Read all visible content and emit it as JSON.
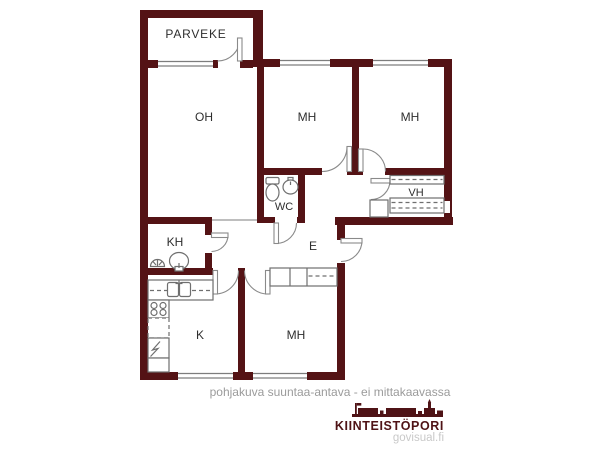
{
  "floorplan": {
    "type": "apartment-floor-plan",
    "rooms": [
      {
        "id": "parveke",
        "label": "PARVEKE"
      },
      {
        "id": "oh",
        "label": "OH"
      },
      {
        "id": "mh-top-left",
        "label": "MH"
      },
      {
        "id": "mh-top-right",
        "label": "MH"
      },
      {
        "id": "vh",
        "label": "VH"
      },
      {
        "id": "wc",
        "label": "WC"
      },
      {
        "id": "kh",
        "label": "KH"
      },
      {
        "id": "e",
        "label": "E"
      },
      {
        "id": "k",
        "label": "K"
      },
      {
        "id": "mh-bottom",
        "label": "MH"
      }
    ],
    "fixtures": [
      "toilet-icon",
      "wc-sink-icon",
      "shower-drain-icon",
      "washbasin-icon",
      "kitchen-sink-icon",
      "stove-icon",
      "fridge-icon",
      "wardrobe-icon",
      "shelf-icon",
      "door-arc",
      "window"
    ],
    "colors": {
      "wall": "#541315",
      "fixture-line": "#7d7d7d",
      "label": "#2e2e2e"
    }
  },
  "footer": {
    "disclaimer": "pohjakuva suuntaa-antava - ei mittakaavassa",
    "logo": {
      "brand": "KIINTEISTÖPORI",
      "site": "govisual.fi",
      "brand_color": "#4f1316",
      "site_color": "#c9c9c9"
    }
  }
}
